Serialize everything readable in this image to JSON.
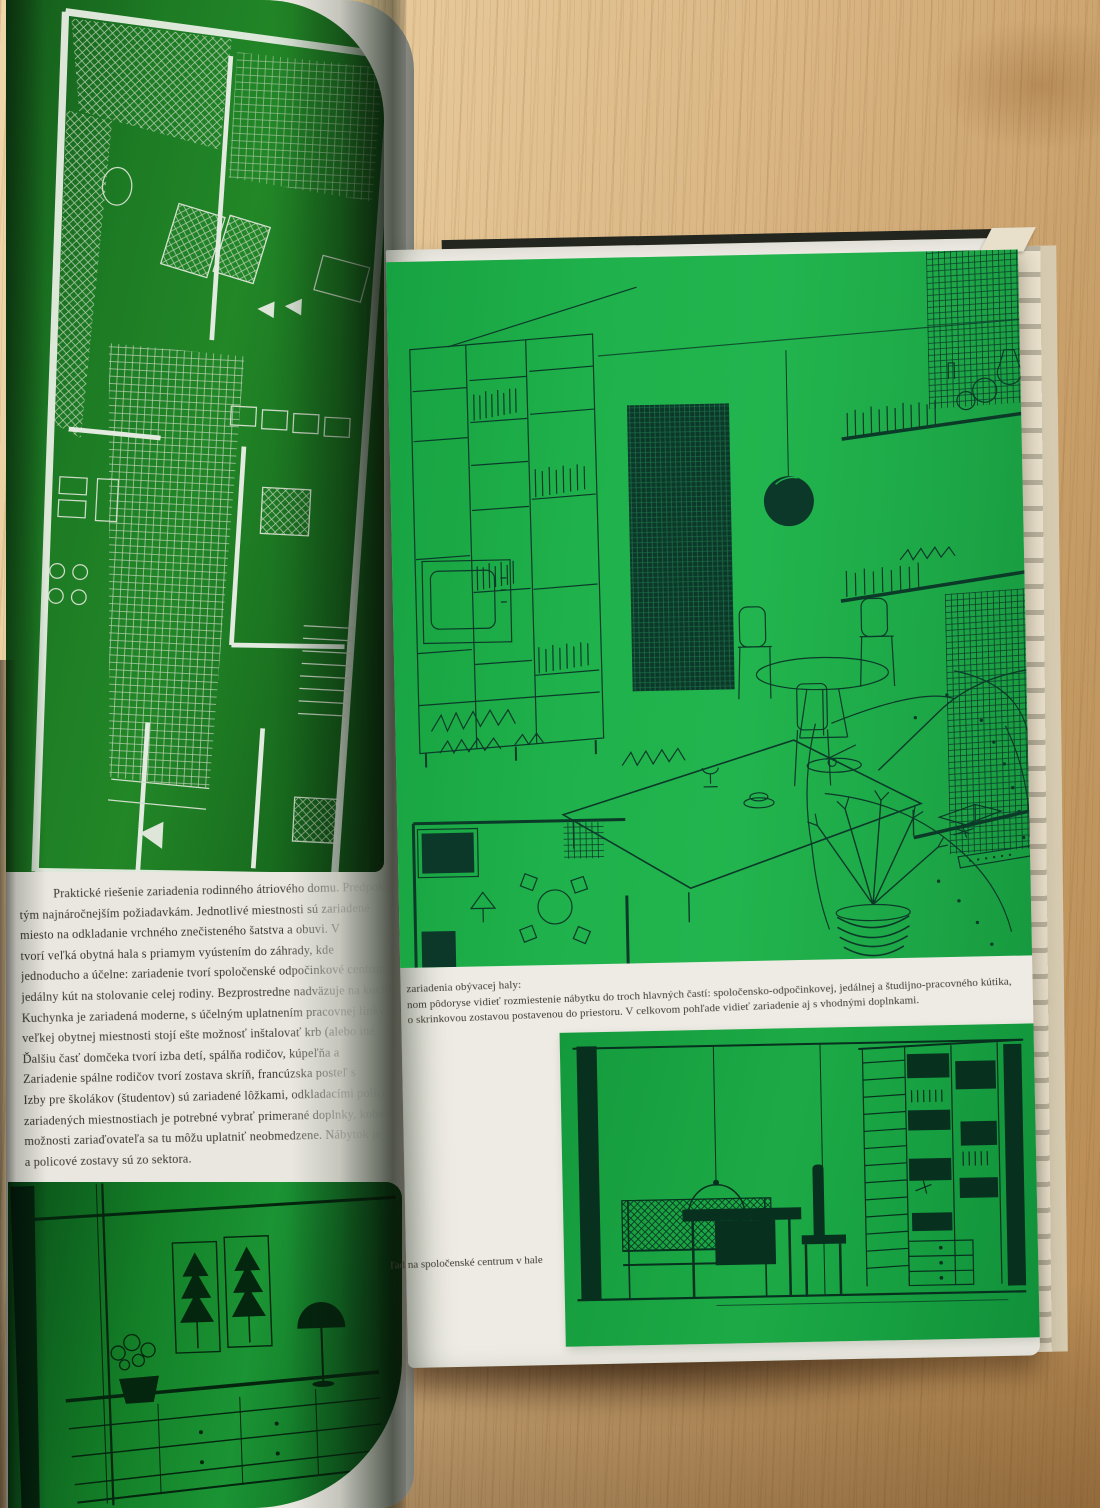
{
  "book": {
    "left_page": {
      "paragraph_lines": [
        "Praktické riešenie zariadenia rodinného átriového domu. Predpokladáme",
        "tým najnáročnejším požiadavkám. Jednotlivé miestnosti sú zariadené",
        "miesto na odkladanie vrchného znečisteného šatstva a obuvi. V",
        "tvorí veľká obytná hala s priamym vyústením do záhrady, kde",
        "jednoducho a účelne: zariadenie tvorí spoločenské odpočinkové centrum a",
        "jedálny kút na stolovanie celej rodiny. Bezprostredne nadväzuje na kuchyňu",
        "Kuchynka je zariadená moderne, s účelným uplatnením pracovnej linky. Aj",
        "veľkej obytnej miestnosti stojí ešte možnosť inštalovať krb (alebo iné",
        "Ďalšiu časť domčeka tvorí izba detí, spálňa rodičov, kúpeľňa a",
        "Zariadenie spálne rodičov tvorí zostava skríň, francúzska posteľ s",
        "Izby pre školákov (študentov) sú zariadené lôžkami, odkladacími policami a",
        "zariadených miestnostiach je potrebné vybrať primerané doplnky, koberec,",
        "možnosti zariaďovateľa sa tu môžu uplatniť neobmedzene. Nábytok je",
        "a policové zostavy sú zo sektora."
      ],
      "illustration_top": "floor-plan-of-atrium-family-house",
      "illustration_bottom": "sideboard-elevation-with-plants-and-lamp"
    },
    "right_page": {
      "caption_lines": [
        "zariadenia obývacej haly:",
        "nom pôdoryse vidieť rozmiestenie nábytku do troch hlavných častí: spoločensko-odpočinkovej, jedálnej a študijno-pracovného kútika,",
        "o skrinkovou zostavou postavenou do priestoru. V celkovom pohľade vidieť zariadenie aj s vhodnými doplnkami."
      ],
      "bottom_caption": "ľad na spoločenské centrum v hale",
      "illustration_main": "living-room-perspective-with-wall-unit-curtain-dining-set-shelves-sofa",
      "illustration_bottom": "dining-corner-and-bookshelf-elevation"
    }
  },
  "colors": {
    "left_page_green": "#1d7b24",
    "right_page_green": "#1fb14b",
    "bottom_left_panel_green": "#148028",
    "drawing_ink_dark": "#0b3a29",
    "floor_plan_print_light": "#cfdcc9",
    "paper_white": "#edebe3",
    "wood_light": "#e6c797",
    "wood_dark": "#b68850"
  }
}
